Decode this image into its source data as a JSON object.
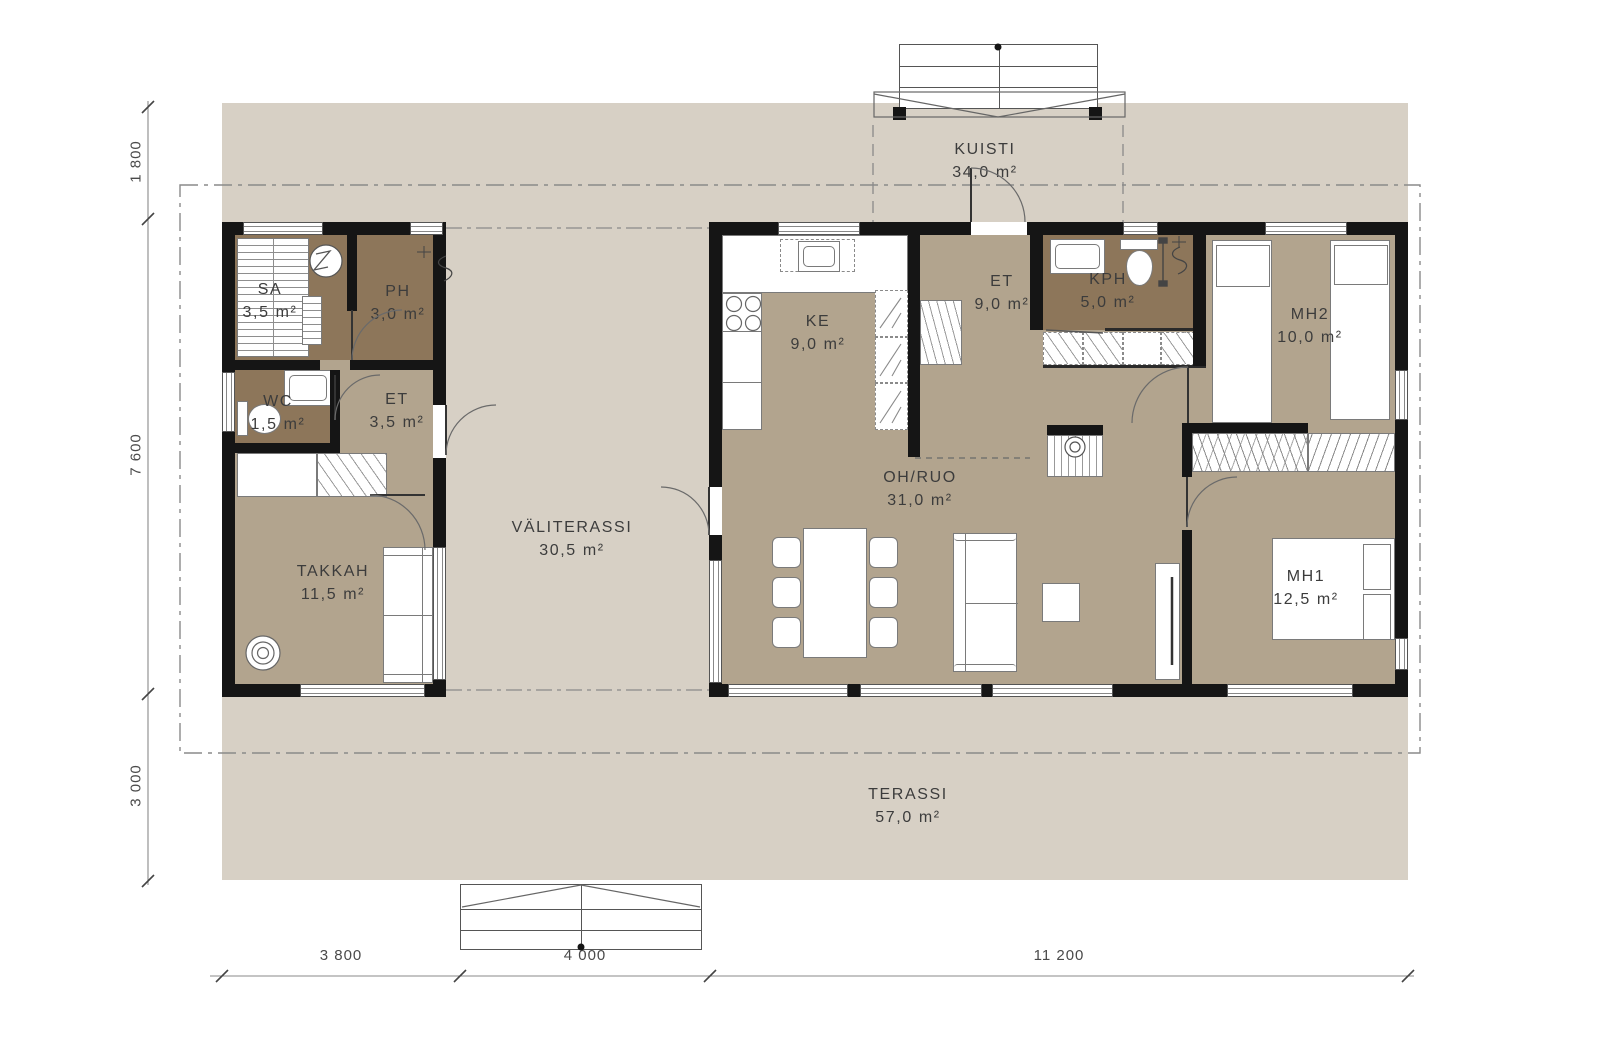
{
  "plan": {
    "colors": {
      "deck": "#d7d0c5",
      "floor": "#b2a48e",
      "wet": "#8d765a",
      "wall": "#151515",
      "line": "#5a5a5a",
      "text": "#3c3c3c",
      "dim": "#4a4a4a"
    },
    "rooms": [
      {
        "id": "kuisti",
        "label": "KUISTI",
        "area": "34,0 m²"
      },
      {
        "id": "sa",
        "label": "SA",
        "area": "3,5 m²"
      },
      {
        "id": "ph",
        "label": "PH",
        "area": "3,0 m²"
      },
      {
        "id": "wc",
        "label": "WC",
        "area": "1,5 m²"
      },
      {
        "id": "et-left",
        "label": "ET",
        "area": "3,5 m²"
      },
      {
        "id": "takkah",
        "label": "TAKKAH",
        "area": "11,5 m²"
      },
      {
        "id": "valiterassi",
        "label": "VÄLITERASSI",
        "area": "30,5 m²"
      },
      {
        "id": "ke",
        "label": "KE",
        "area": "9,0 m²"
      },
      {
        "id": "et-right",
        "label": "ET",
        "area": "9,0 m²"
      },
      {
        "id": "kph",
        "label": "KPH",
        "area": "5,0 m²"
      },
      {
        "id": "mh2",
        "label": "MH2",
        "area": "10,0 m²"
      },
      {
        "id": "oh-ruo",
        "label": "OH/RUO",
        "area": "31,0 m²"
      },
      {
        "id": "mh1",
        "label": "MH1",
        "area": "12,5 m²"
      },
      {
        "id": "terassi",
        "label": "TERASSI",
        "area": "57,0 m²"
      }
    ],
    "dimensions": {
      "left": [
        {
          "label": "1 800"
        },
        {
          "label": "7 600"
        },
        {
          "label": "3 000"
        }
      ],
      "bottom": [
        {
          "label": "3 800"
        },
        {
          "label": "4 000"
        },
        {
          "label": "11 200"
        }
      ]
    }
  }
}
